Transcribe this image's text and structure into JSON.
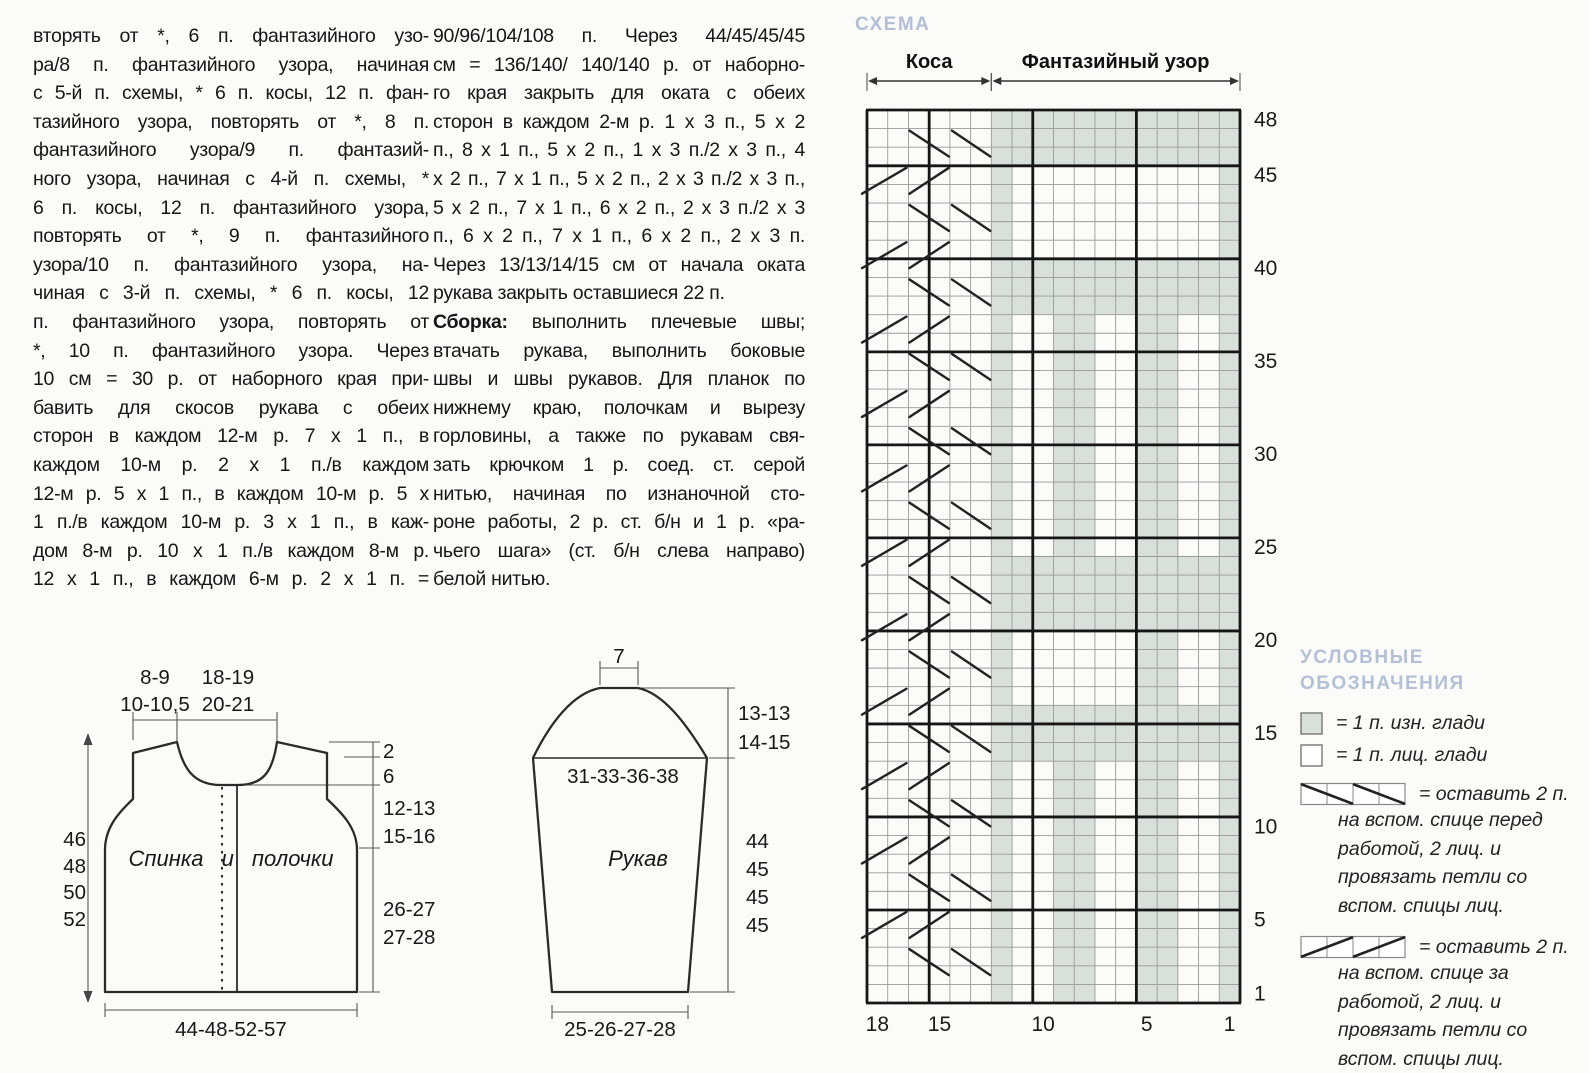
{
  "article": {
    "col1_lines": [
      "вторять от *, 6 п. фантазийного узо-",
      "ра/8 п. фантазийного узора, начиная",
      "с 5-й п. схемы, * 6 п. косы, 12 п. фан-",
      "тазийного узора, повторять от *, 8 п.",
      "фантазийного узора/9 п. фантазий-",
      "ного узора, начиная с 4-й п. схемы, *",
      "6 п. косы, 12 п. фантазийного узора,",
      "повторять от *, 9 п. фантазийного",
      "узора/10 п. фантазийного узора, на-",
      "чиная с 3-й п. схемы, * 6 п. косы, 12",
      "п. фантазийного узора, повторять от",
      "*, 10 п. фантазийного узора. Через",
      "10 см = 30 р. от наборного края при-",
      "бавить для скосов рукава с обеих",
      "сторон  в каждом 12-м р. 7 х 1 п., в",
      "каждом 10-м р. 2 х 1 п./в каждом",
      "12-м р. 5 х 1 п., в каждом 10-м р. 5 х",
      "1 п./в каждом 10-м р. 3 х 1 п., в каж-",
      "дом 8-м р. 10 х 1 п./в каждом 8-м р.",
      "12 х 1 п., в каждом 6-м р. 2 х 1 п. ="
    ],
    "col2_lines_pre": [
      "90/96/104/108 п. Через 44/45/45/45",
      "см = 136/140/ 140/140 р. от наборно-",
      "го края закрыть для оката с обеих",
      "сторон в каждом 2-м р. 1 х 3 п., 5 х 2",
      "п., 8 х 1 п., 5 х 2 п., 1 х 3 п./2 х 3 п., 4",
      "х 2 п., 7 х 1 п., 5 х 2 п., 2 х 3 п./2 х 3 п.,",
      "5 х 2 п., 7 х 1 п., 6 х 2 п., 2 х 3 п./2 х 3",
      "п., 6 х 2 п., 7 х 1 п., 6 х 2 п., 2 х 3 п.",
      "Через 13/13/14/15 см от начала оката",
      "рукава закрыть оставшиеся 22 п."
    ],
    "col2_bold_label": "Сборка:",
    "col2_bold_rest": " выполнить плечевые швы;",
    "col2_lines_post": [
      "втачать рукава, выполнить боковые",
      "швы и швы рукавов. Для планок по",
      "нижнему краю, полочкам и вырезу",
      "горловины, а также по рукавам свя-",
      "зать крючком 1 р. соед. ст. серой",
      "нитью, начиная по изнаночной сто-",
      "роне работы, 2 р. ст. б/н и 1 р. «ра-",
      "чьего шага» (ст. б/н слева направо)",
      "белой нитью."
    ]
  },
  "chart": {
    "title": "СХЕМА",
    "title_color": "#b3c0d6",
    "gray_color": "#d9dfda",
    "grid_line_color": "#9a9a9a",
    "bold_line_color": "#161616",
    "cols": 18,
    "rows": 48,
    "span_labels": [
      {
        "label": "Коса",
        "from": 0,
        "to": 6
      },
      {
        "label": "Фантазийный узор",
        "from": 6,
        "to": 18
      }
    ],
    "row_labels": [
      48,
      45,
      40,
      35,
      30,
      25,
      20,
      15,
      10,
      5,
      1
    ],
    "col_labels": [
      {
        "stitch": "18",
        "col": 0
      },
      {
        "stitch": "15",
        "col": 3
      },
      {
        "stitch": "10",
        "col": 8
      },
      {
        "stitch": "5",
        "col": 13
      },
      {
        "stitch": "1",
        "col": 17
      }
    ],
    "always_gray_cols": [
      6,
      17
    ],
    "bands": [
      [
        46,
        48
      ],
      [
        38,
        40
      ],
      [
        21,
        24
      ],
      [
        14,
        16
      ]
    ],
    "stripes": [
      {
        "rows": [
          25,
          37
        ],
        "cols": [
          9,
          10,
          13,
          14
        ]
      },
      {
        "rows": [
          17,
          20
        ],
        "cols": [
          13,
          14
        ]
      },
      {
        "rows": [
          1,
          13
        ],
        "cols": [
          9,
          10,
          13,
          14
        ]
      }
    ],
    "bold_vertical_gridlines": [
      0,
      3,
      8,
      13,
      18
    ],
    "bold_horizontal_rows": [
      45,
      40,
      35,
      30,
      25,
      20,
      15,
      10,
      5
    ],
    "cable_front_rows": [
      47,
      43,
      39,
      35,
      31,
      27,
      23,
      19,
      15,
      11,
      7,
      3
    ],
    "cable_back_rows": [
      45,
      41,
      37,
      33,
      29,
      25,
      21,
      17,
      13,
      9,
      5
    ]
  },
  "legend": {
    "title_line1": "УСЛОВНЫЕ",
    "title_line2": "ОБОЗНАЧЕНИЯ",
    "items": [
      {
        "symbol": "purl-square-icon",
        "text": "= 1 п. изн. глади"
      },
      {
        "symbol": "knit-square-icon",
        "text": "= 1 п. лиц. глади"
      },
      {
        "symbol": "cable-front-icon",
        "text": "= оставить 2 п.",
        "cont": [
          "на вспом. спице перед",
          "работой, 2 лиц. и",
          "провязать петли со",
          "вспом. спицы лиц."
        ]
      },
      {
        "symbol": "cable-back-icon",
        "text": "= оставить 2 п.",
        "cont": [
          "на вспом. спице за",
          "работой, 2 лиц. и",
          "провязать петли со",
          "вспом. спицы лиц."
        ]
      }
    ]
  },
  "schematics": {
    "body": {
      "label": "Спинка и полочки",
      "shoulder_width_line1": "8-9",
      "shoulder_width_line2": "10-10,5",
      "neck_width_line1": "18-19",
      "neck_width_line2": "20-21",
      "left_lengths": [
        "46",
        "48",
        "50",
        "52"
      ],
      "right_top1": "2",
      "right_top2": "6",
      "armhole_line1": "12-13",
      "armhole_line2": "15-16",
      "side_line1": "26-27",
      "side_line2": "27-28",
      "bottom_width": "44-48-52-57"
    },
    "sleeve": {
      "label": "Рукав",
      "top_width": "7",
      "upper_width": "31-33-36-38",
      "cap_line1": "13-13",
      "cap_line2": "14-15",
      "lengths": [
        "44",
        "45",
        "45",
        "45"
      ],
      "bottom_width": "25-26-27-28"
    }
  }
}
